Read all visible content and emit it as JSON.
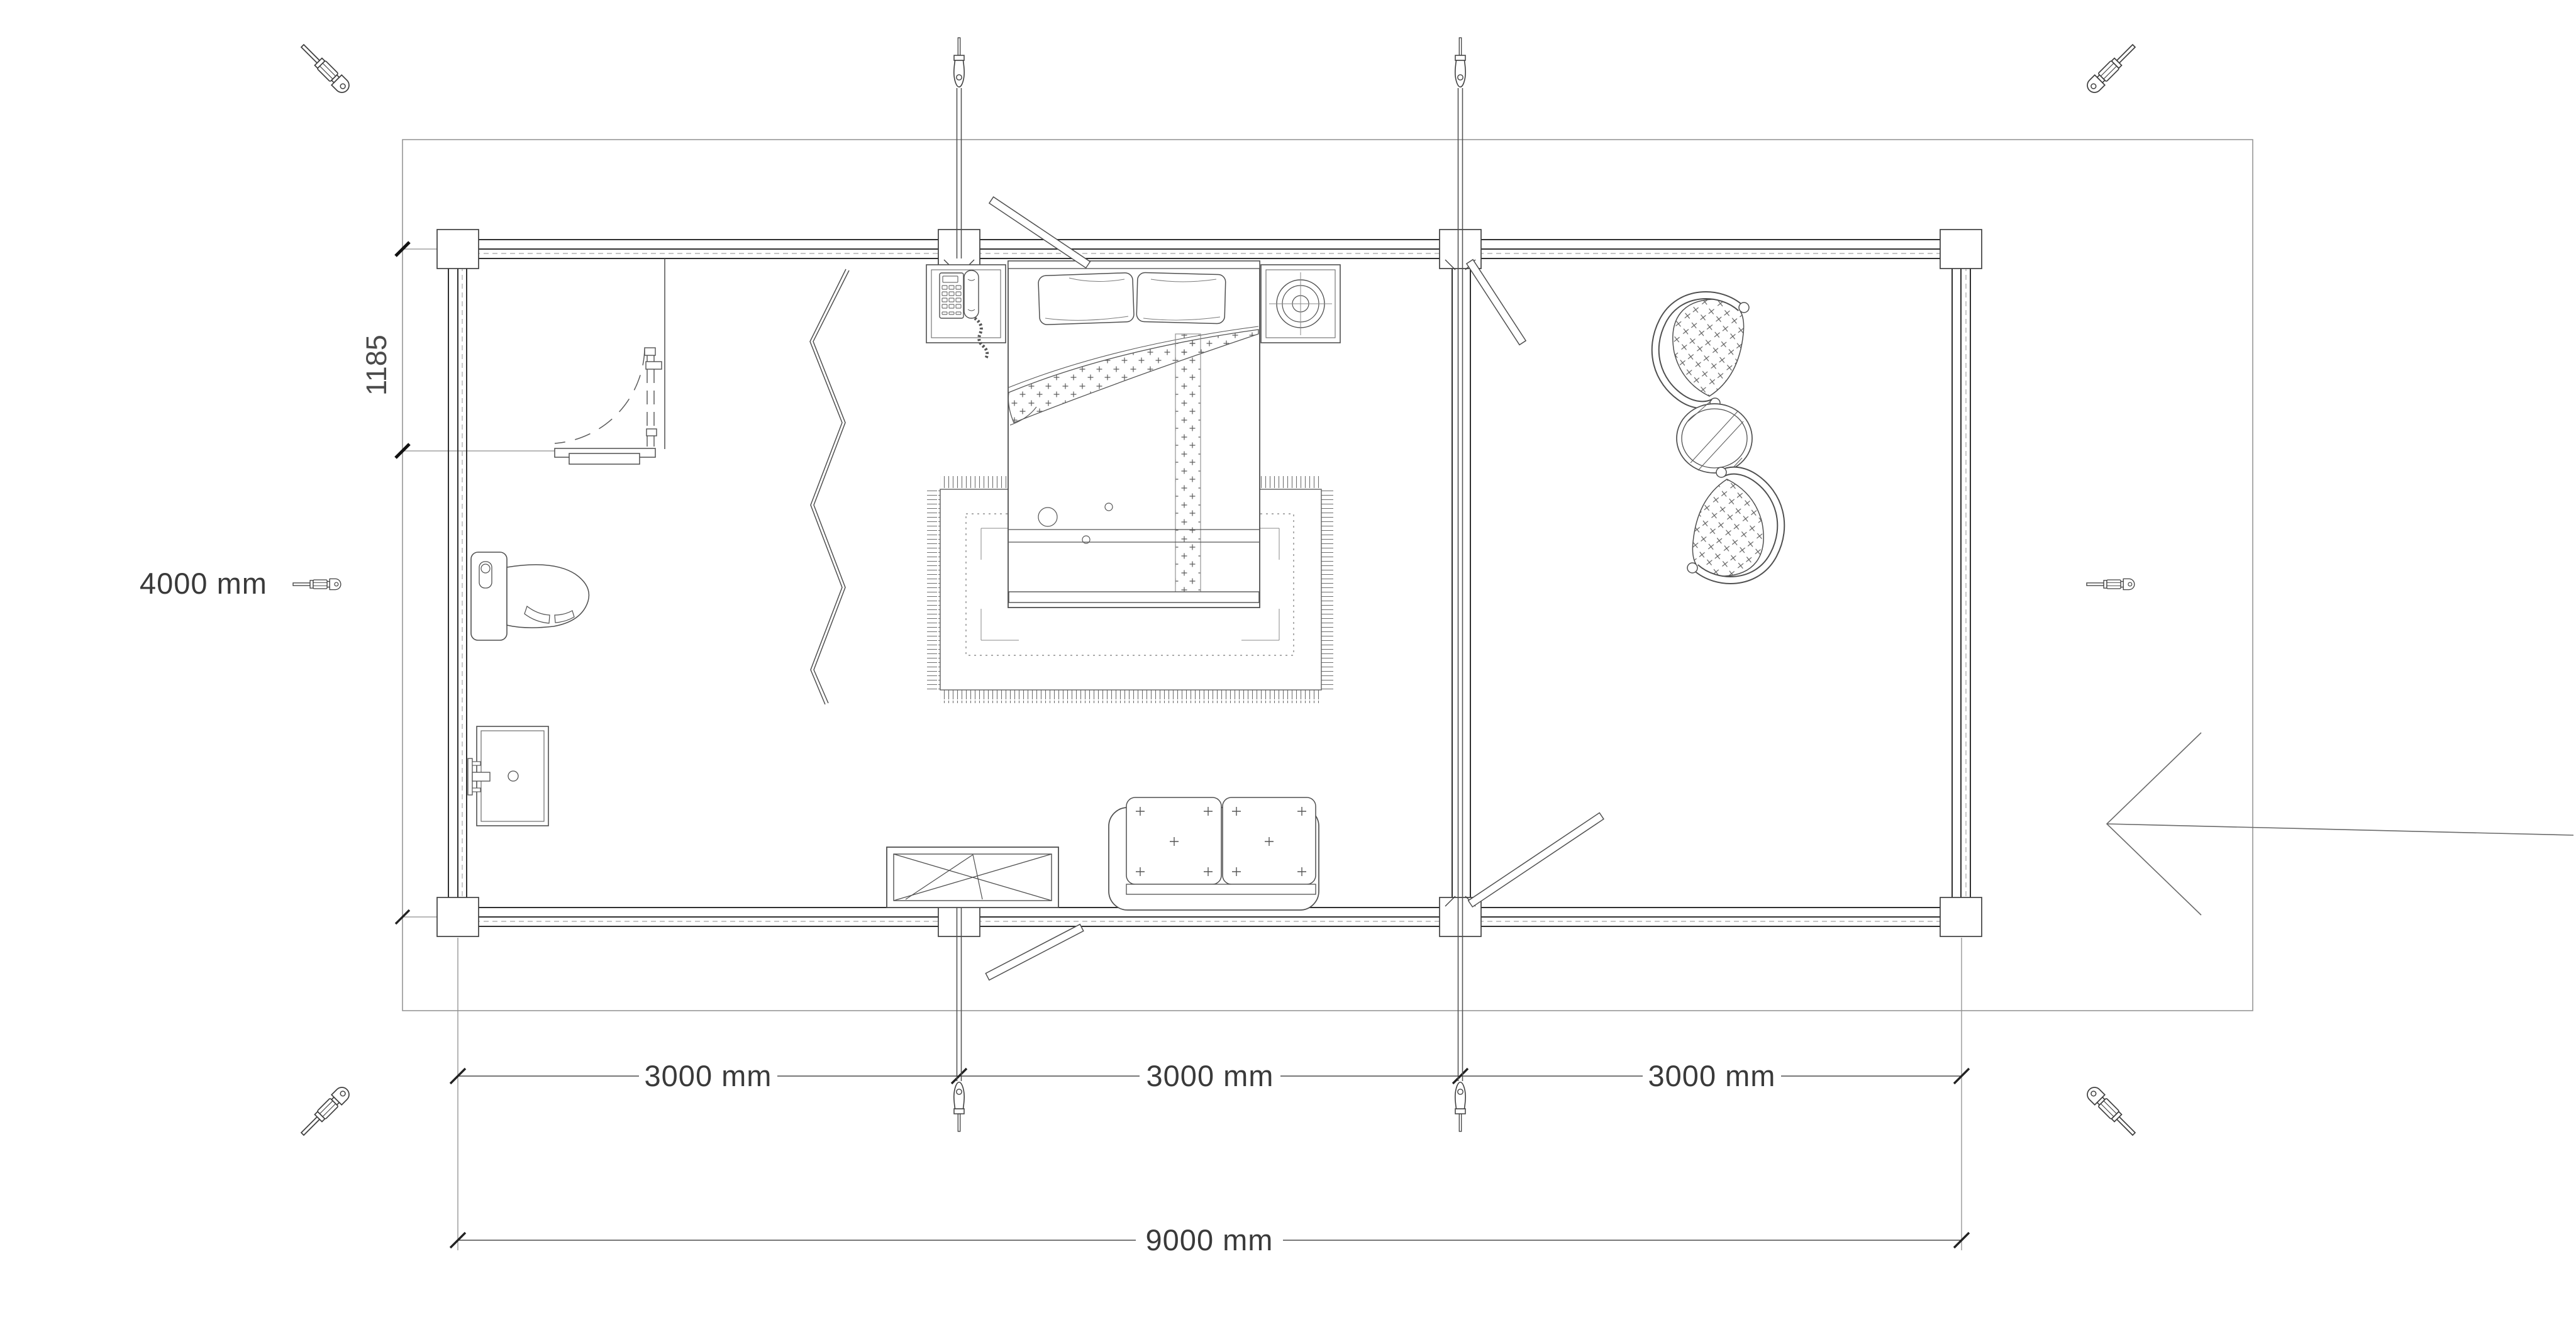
{
  "document": {
    "type": "floor-plan-configurator",
    "background": "#ffffff"
  },
  "dimensions": {
    "height": "4000 mm",
    "door_offset": "1185",
    "modules": [
      "3000 mm",
      "3000 mm",
      "3000 mm"
    ],
    "total": "9000 mm"
  },
  "colors": {
    "wall": "#2f2f2f",
    "furniture_line": "#4f4f4f",
    "dim_text": "#3a3a3a",
    "boundary": "#8f8f8f",
    "tick": "#111111"
  },
  "handles": {
    "corner_handle": "screwdriver-icon",
    "module_handle": "needle-icon",
    "count_corner": 6,
    "count_module": 4
  },
  "furniture": [
    "telephone-nightstand",
    "double-bed",
    "lamp-nightstand",
    "area-rug",
    "toilet",
    "sink-vanity",
    "folding-screen",
    "crossed-coffee-table",
    "loveseat-sofa",
    "paisley-armchair",
    "round-side-table",
    "paisley-armchair"
  ]
}
